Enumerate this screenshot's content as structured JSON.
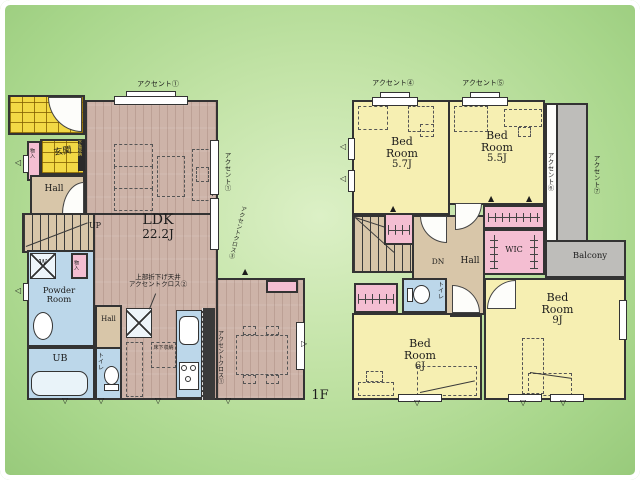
{
  "colors": {
    "background_green": "#a8d68b",
    "wood_floor": "#cdb3a8",
    "bedroom_yellow": "#f6efb2",
    "hall_tan": "#d8c6a9",
    "wet_area_blue": "#bcd7ea",
    "closet_pink": "#f4bed2",
    "balcony_gray": "#bebdba",
    "porch_tile_yellow": "#f2d845",
    "wall": "#333333"
  },
  "floor1": {
    "label": "1F",
    "ldk_name": "LDK",
    "ldk_size": "22.2J",
    "genkan": "玄関",
    "shoe_cabinet": "下駄収納",
    "genkan_storage": "物入",
    "hall": "Hall",
    "hall2": "Hall",
    "up": "UP",
    "washer": "W",
    "laundry_storage": "物入",
    "powder_room": "Powder Room",
    "bath": "UB",
    "toilet": "トイレ",
    "floor_storage": "床下収納",
    "accent_top": "アクセント①",
    "accent_right": "アクセント①",
    "accent_cross_right": "アクセントクロス③",
    "ceiling_note_1": "上部折下げ天井",
    "ceiling_note_2": "アクセントクロス②",
    "accent_kitchen": "アクセントクロス①"
  },
  "floor2": {
    "bed1_name": "Bed Room",
    "bed1_size": "5.7J",
    "bed2_name": "Bed Room",
    "bed2_size": "5.5J",
    "bed3_name": "Bed Room",
    "bed3_size": "6J",
    "bed4_name": "Bed Room",
    "bed4_size": "9J",
    "hall": "Hall",
    "dn": "DN",
    "wic": "WIC",
    "balcony": "Balcony",
    "toilet": "トイレ",
    "accent_top_left": "アクセント④",
    "accent_top_right": "アクセント⑤",
    "accent_right_inner": "アクセント⑥",
    "accent_right_outer": "アクセント⑦"
  }
}
